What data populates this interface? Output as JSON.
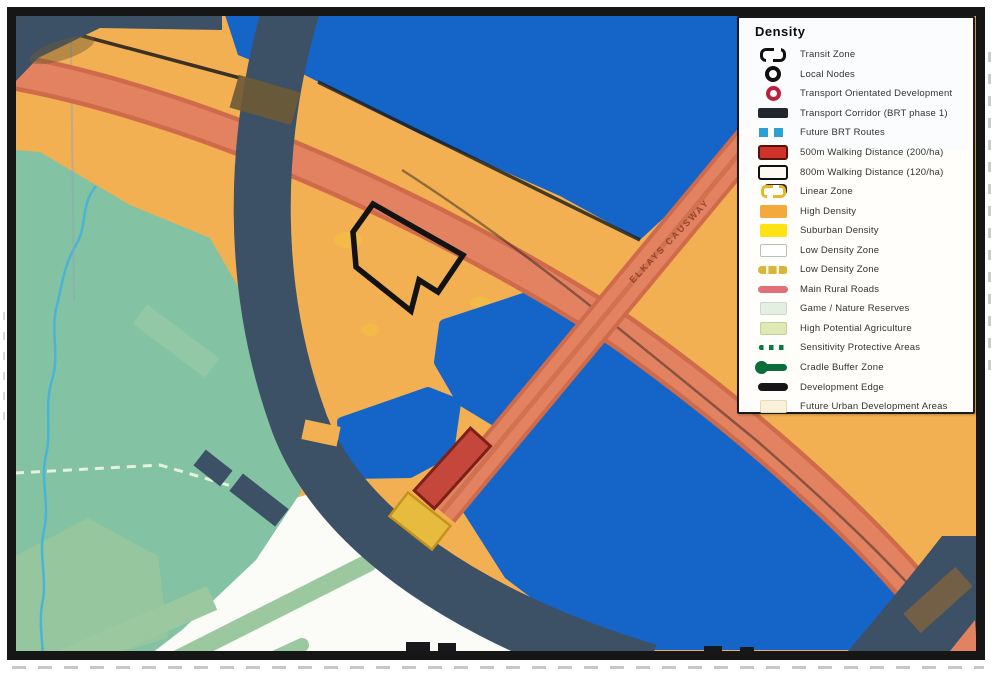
{
  "legend": {
    "title": "Density",
    "items": [
      {
        "label": "Transit Zone",
        "icon": "transit-zone-icon"
      },
      {
        "label": "Local Nodes",
        "icon": "local-nodes-icon"
      },
      {
        "label": "Transport Orientated Development",
        "icon": "transport-orientated-development-icon"
      },
      {
        "label": "Transport Corridor (BRT phase 1)",
        "icon": "transport-corridor-icon"
      },
      {
        "label": "Future BRT Routes",
        "icon": "future-brt-routes-icon"
      },
      {
        "label": "500m Walking Distance (200/ha)",
        "icon": "walking-distance-500m-icon"
      },
      {
        "label": "800m Walking Distance (120/ha)",
        "icon": "walking-distance-800m-icon"
      },
      {
        "label": "Linear Zone",
        "icon": "linear-zone-icon"
      },
      {
        "label": "High Density",
        "icon": "high-density-icon"
      },
      {
        "label": "Suburban Density",
        "icon": "suburban-density-icon"
      },
      {
        "label": "Low Density Zone",
        "icon": "low-density-zone-icon"
      },
      {
        "label": "Low Density Zone",
        "icon": "low-density-zone-line-icon"
      },
      {
        "label": "Main Rural Roads",
        "icon": "main-rural-roads-icon"
      },
      {
        "label": "Game / Nature Reserves",
        "icon": "game-nature-reserves-icon"
      },
      {
        "label": "High Potential Agriculture",
        "icon": "high-potential-agriculture-icon"
      },
      {
        "label": "Sensitivity Protective Areas",
        "icon": "sensitivity-protective-areas-icon"
      },
      {
        "label": "Cradle Buffer Zone",
        "icon": "cradle-buffer-zone-icon"
      },
      {
        "label": "Development Edge",
        "icon": "development-edge-icon"
      },
      {
        "label": "Future Urban Development Areas",
        "icon": "future-urban-development-areas-icon"
      }
    ]
  },
  "map": {
    "road_label": "ELKAYS CAUSWAY"
  },
  "colors": {
    "royal_blue": "#1565c8",
    "navy": "#3c5066",
    "orange": "#f2b052",
    "salmon": "#e28260",
    "salmon_edge": "#cf6a4a",
    "red_box": "#c5463a",
    "red_box_border": "#7c2018",
    "teal_green": "#83c2a2",
    "sage_green": "#9bc89e",
    "white_zone": "#fbfbf7",
    "gold": "#e7bb3d",
    "gold_border": "#c2941e",
    "stream_blue": "#4ab4d6",
    "olive_overlap": "#6d5a35",
    "yellow_patch": "#f6c43e",
    "frame_black": "#161616",
    "edge_black": "#1c1c1c"
  }
}
